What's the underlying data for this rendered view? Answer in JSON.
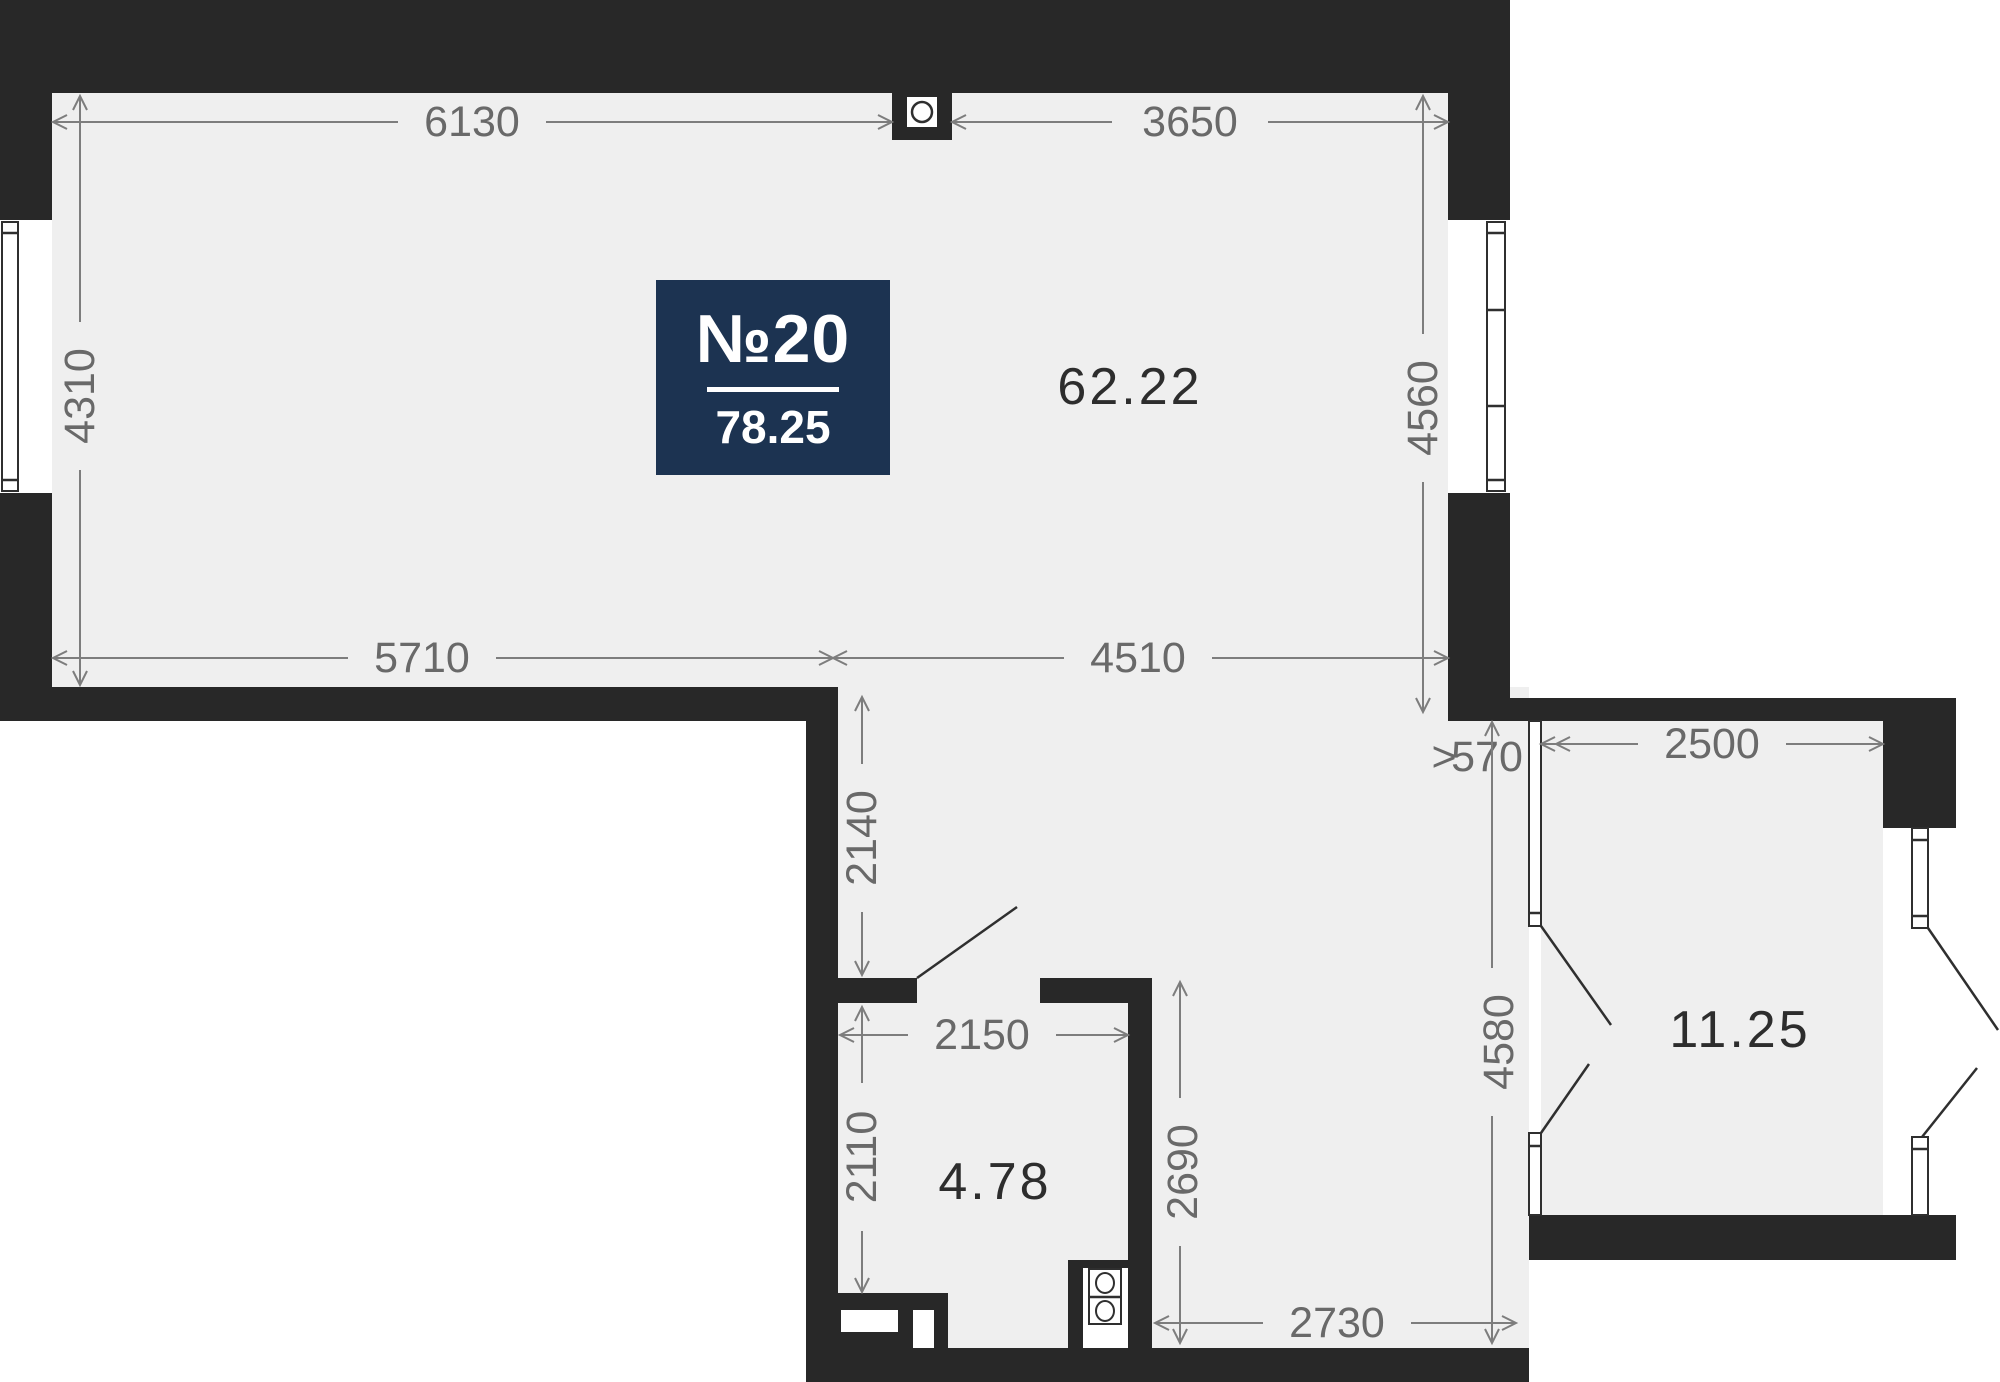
{
  "plan": {
    "badge": {
      "number": "№20",
      "area": "78.25"
    },
    "rooms": [
      {
        "id": "living-kitchen",
        "area": "62.22"
      },
      {
        "id": "bedroom",
        "area": "11.25"
      },
      {
        "id": "bathroom",
        "area": "4.78"
      }
    ],
    "dimensions": {
      "top_left": "6130",
      "top_right": "3650",
      "left": "4310",
      "right": "4560",
      "mid_left": "5710",
      "mid_right": "4510",
      "hall_top": "2140",
      "gap_marker": ">",
      "gap": "570",
      "bedroom_width": "2500",
      "hall_right": "4580",
      "bath_width": "2150",
      "bath_height": "2110",
      "kitchen_height": "2690",
      "hall_bottom": "2730"
    },
    "icons": {
      "ventilation": "circle-in-square",
      "stove": "two-burner-stove"
    },
    "colors": {
      "wall": "#282828",
      "floor": "#efefef",
      "exterior": "#ffffff",
      "badge_bg": "#1c3351",
      "badge_text": "#ffffff",
      "dim_line": "#7d7d7d",
      "dim_text": "#696969",
      "area_text": "#2d2d2d",
      "door_line": "#2f2f2f"
    }
  }
}
